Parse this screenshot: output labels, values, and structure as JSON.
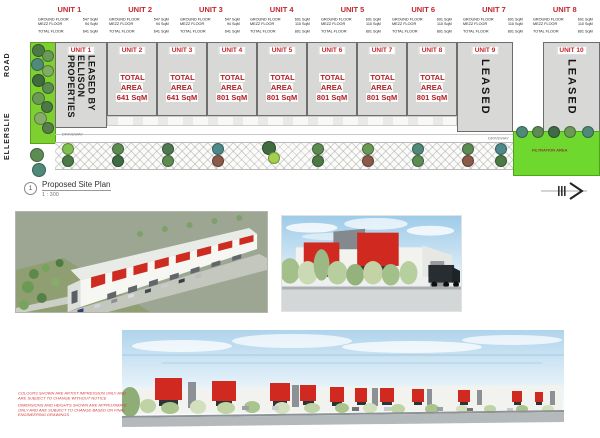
{
  "header": {
    "units": [
      {
        "label": "UNIT 1",
        "rows": [
          [
            "GROUND FLOOR",
            "547 SqM"
          ],
          [
            "MEZZ FLOOR",
            "94 SqM"
          ],
          [
            "TOTAL FLOOR",
            "641 SqM"
          ]
        ]
      },
      {
        "label": "UNIT 2",
        "rows": [
          [
            "GROUND FLOOR",
            "547 SqM"
          ],
          [
            "MEZZ FLOOR",
            "94 SqM"
          ],
          [
            "TOTAL FLOOR",
            "641 SqM"
          ]
        ]
      },
      {
        "label": "UNIT 3",
        "rows": [
          [
            "GROUND FLOOR",
            "547 SqM"
          ],
          [
            "MEZZ FLOOR",
            "94 SqM"
          ],
          [
            "TOTAL FLOOR",
            "641 SqM"
          ]
        ]
      },
      {
        "label": "UNIT 4",
        "rows": [
          [
            "GROUND FLOOR",
            "691 SqM"
          ],
          [
            "MEZZ FLOOR",
            "110 SqM"
          ],
          [
            "TOTAL FLOOR",
            "801 SqM"
          ]
        ]
      },
      {
        "label": "UNIT 5",
        "rows": [
          [
            "GROUND FLOOR",
            "691 SqM"
          ],
          [
            "MEZZ FLOOR",
            "110 SqM"
          ],
          [
            "TOTAL FLOOR",
            "801 SqM"
          ]
        ]
      },
      {
        "label": "UNIT 6",
        "rows": [
          [
            "GROUND FLOOR",
            "691 SqM"
          ],
          [
            "MEZZ FLOOR",
            "110 SqM"
          ],
          [
            "TOTAL FLOOR",
            "801 SqM"
          ]
        ]
      },
      {
        "label": "UNIT 7",
        "rows": [
          [
            "GROUND FLOOR",
            "691 SqM"
          ],
          [
            "MEZZ FLOOR",
            "110 SqM"
          ],
          [
            "TOTAL FLOOR",
            "801 SqM"
          ]
        ]
      },
      {
        "label": "UNIT 8",
        "rows": [
          [
            "GROUND FLOOR",
            "691 SqM"
          ],
          [
            "MEZZ FLOOR",
            "110 SqM"
          ],
          [
            "TOTAL FLOOR",
            "801 SqM"
          ]
        ]
      },
      {
        "label": "UNIT 9",
        "rows": [
          [
            "GROUND FLOOR",
            "691 SqM"
          ],
          [
            "MEZZ FLOOR",
            "110 SqM"
          ],
          [
            "TOTAL FLOOR",
            "801 SqM"
          ]
        ]
      },
      {
        "label": "UNIT 10",
        "rows": [
          [
            "GROUND FLOOR",
            "691 SqM"
          ],
          [
            "MEZZ FLOOR",
            "110 SqM"
          ],
          [
            "TOTAL FLOOR",
            "801 SqM"
          ]
        ]
      }
    ]
  },
  "plan": {
    "road_name": "ELLERSLIE",
    "road_word": "ROAD",
    "units": [
      {
        "label": "UNIT 1",
        "leased": "LEASED BY ELLISON PROPERTIES"
      },
      {
        "label": "UNIT 2",
        "area_title": "TOTAL AREA",
        "area_value": "641 SqM"
      },
      {
        "label": "UNIT 3",
        "area_title": "TOTAL AREA",
        "area_value": "641 SqM"
      },
      {
        "label": "UNIT 4",
        "area_title": "TOTAL AREA",
        "area_value": "801 SqM"
      },
      {
        "label": "UNIT 5",
        "area_title": "TOTAL AREA",
        "area_value": "801 SqM"
      },
      {
        "label": "UNIT 6",
        "area_title": "TOTAL AREA",
        "area_value": "801 SqM"
      },
      {
        "label": "UNIT 7",
        "area_title": "TOTAL AREA",
        "area_value": "801 SqM"
      },
      {
        "label": "UNIT 8",
        "area_title": "TOTAL AREA",
        "area_value": "801 SqM"
      },
      {
        "label": "UNIT 9",
        "leased": "LEASED"
      },
      {
        "label": "UNIT 10",
        "leased": "LEASED"
      }
    ],
    "driveway_label": "DRIVEWAY",
    "filtration_label": "FILTRATION AREA",
    "title_number": "1",
    "title": "Proposed Site Plan",
    "scale": "1 : 300"
  },
  "disclaimer": {
    "p1": "COLOURS SHOWN ARE ARTIST IMPRESSION ONLY AND ARE SUBJECT TO CHANGE WITHOUT NOTICE",
    "p2": "DIMENSIONS AND HEIGHTS SHOWN ARE APPROXIMATE ONLY AND ARE SUBJECT TO CHANGE BASED ON FINAL ENGINEERING DRAWINGS"
  },
  "colors": {
    "unit_label_red": "#c1272d",
    "canopy_red": "#d02a20",
    "plan_grey": "#d8d8d6",
    "verge_green": "#7ed02f",
    "sky_blue": "#aed4ec"
  }
}
